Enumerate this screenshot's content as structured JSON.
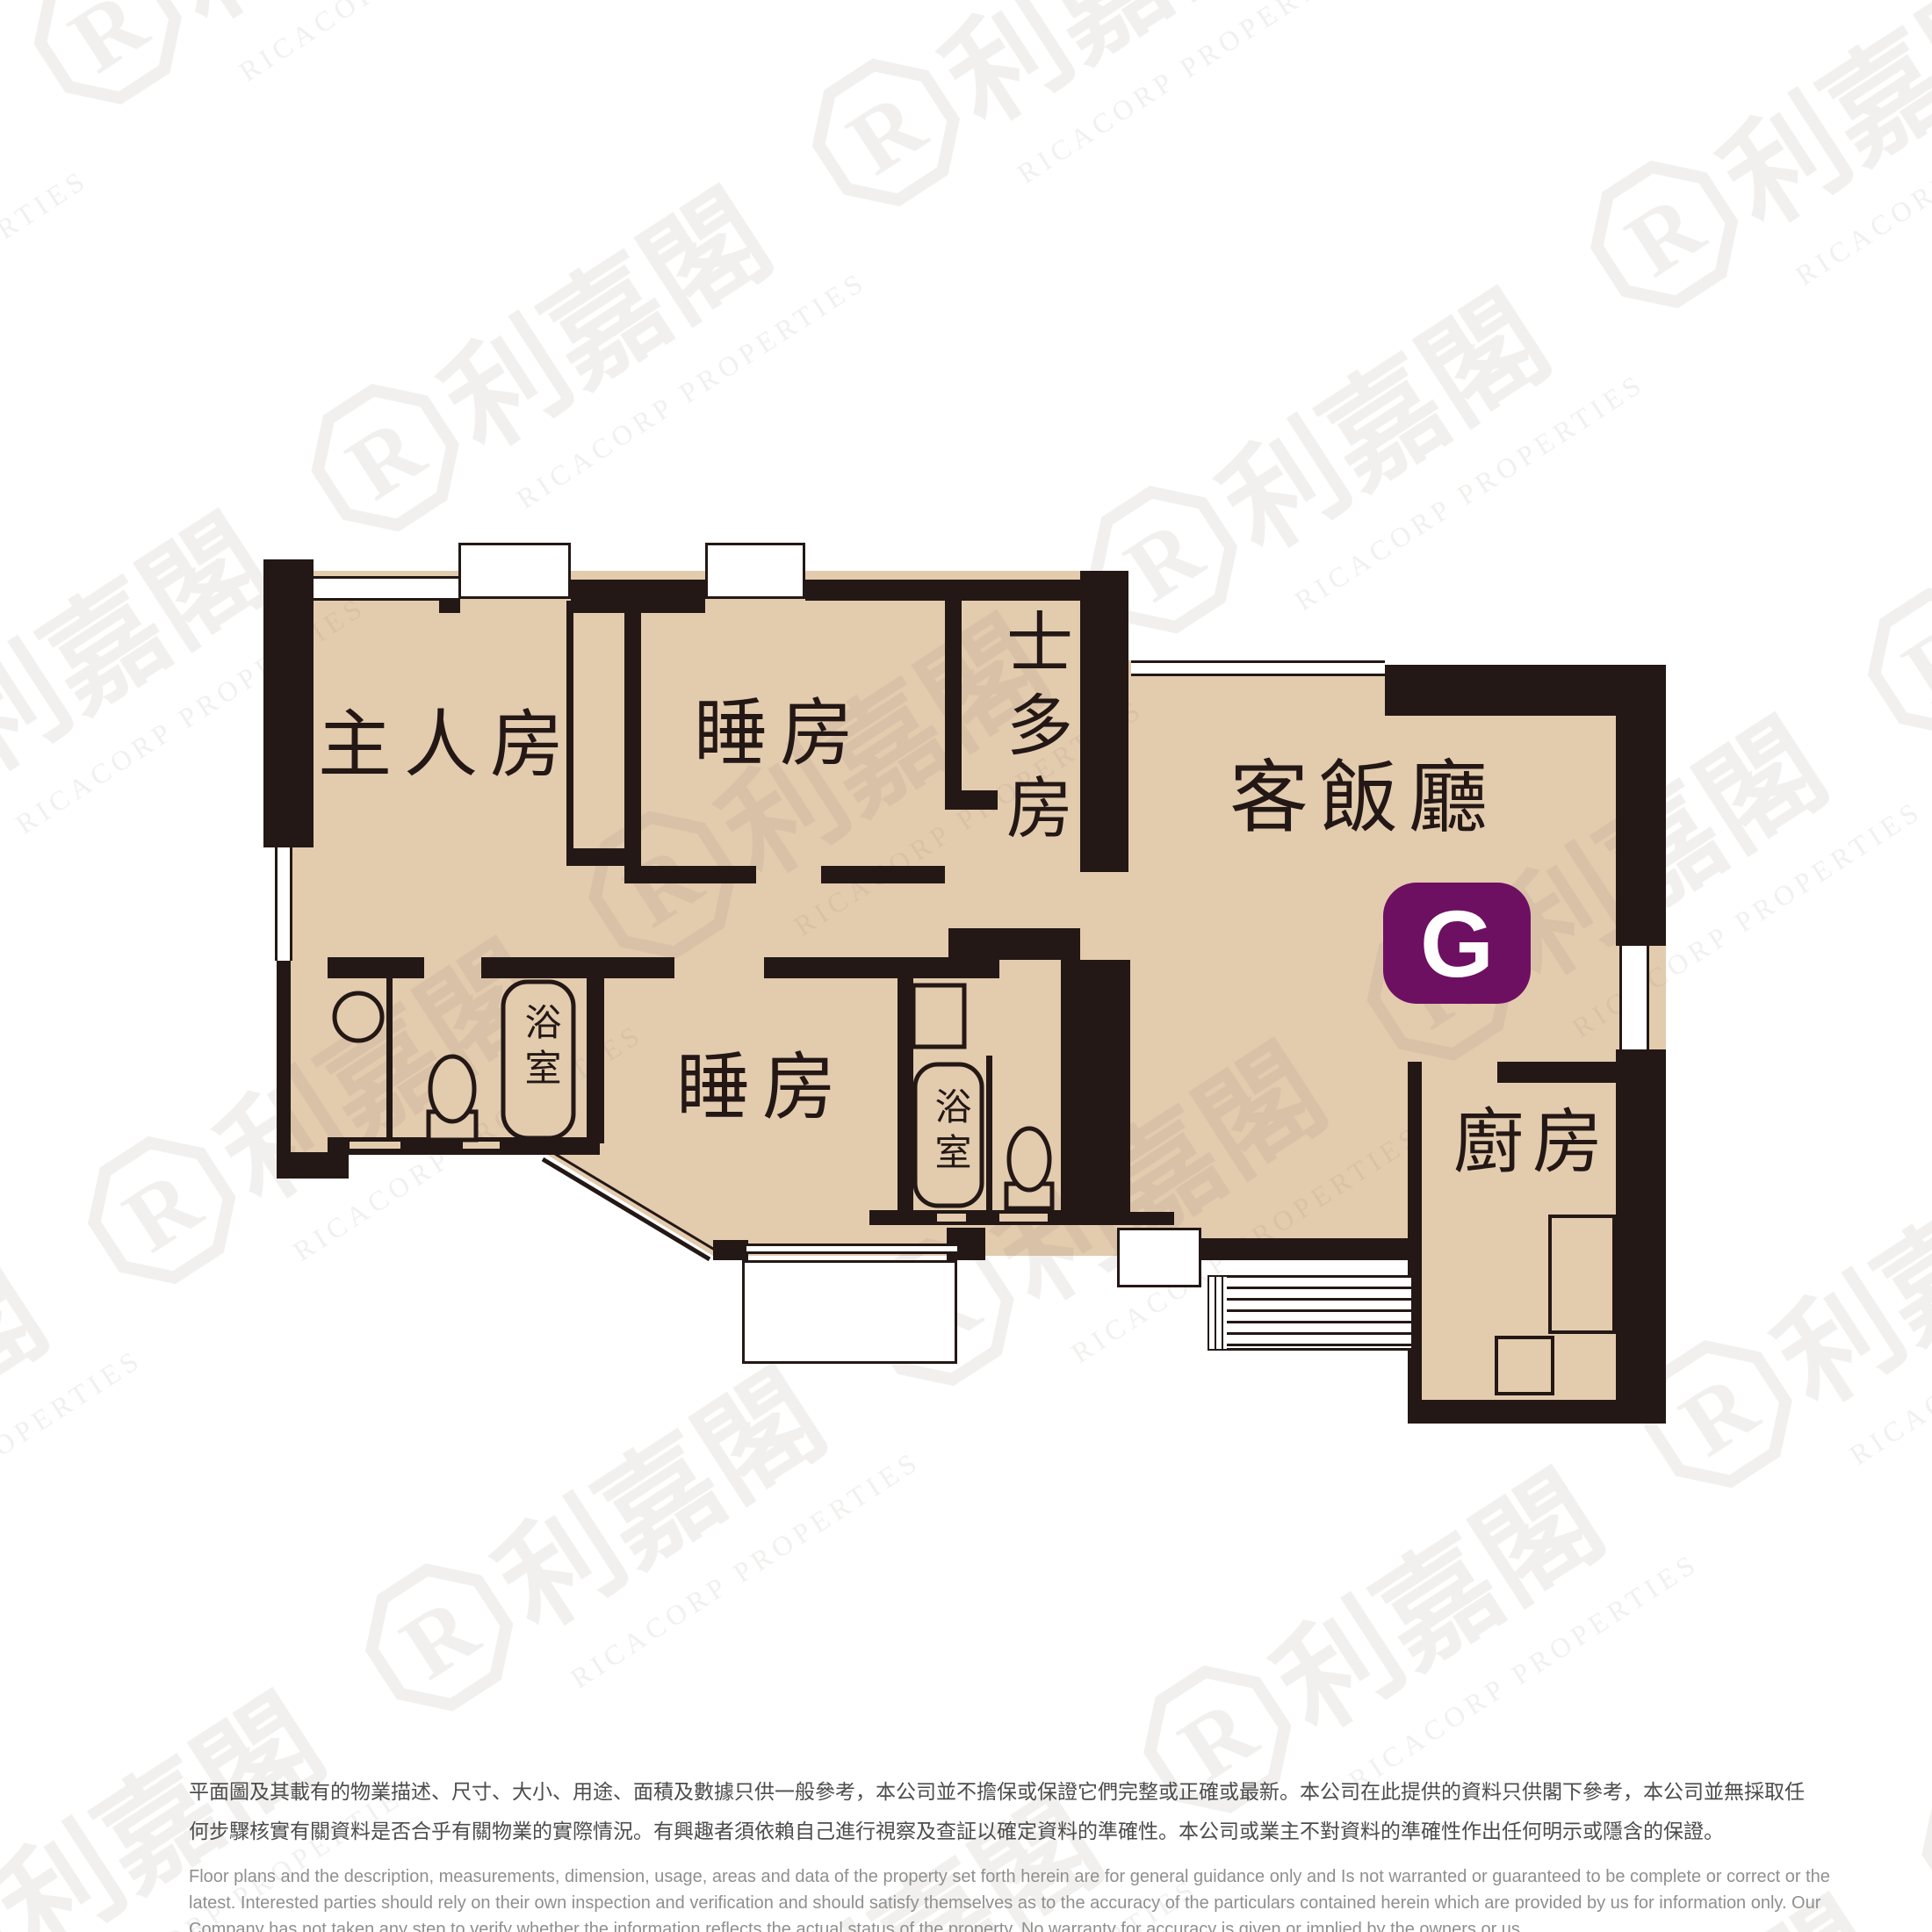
{
  "floor_plan": {
    "unit_badge": "G",
    "badge_color": "#6D1062",
    "floor_color": "#E3CBAE",
    "wall_color": "#231815",
    "rooms": {
      "master_bedroom": {
        "label": "主人房"
      },
      "bedroom_top": {
        "label": "睡房"
      },
      "storeroom": {
        "label": "士多房"
      },
      "living_dining": {
        "label": "客飯廳"
      },
      "bedroom_bottom": {
        "label": "睡房"
      },
      "bathroom_1": {
        "label": "浴室"
      },
      "bathroom_2": {
        "label": "浴室"
      },
      "kitchen": {
        "label": "廚房"
      }
    }
  },
  "watermark": {
    "logo_letter": "R",
    "logo_text": "利嘉閣",
    "company_text": "RICACORP PROPERTIES"
  },
  "disclaimer": {
    "chinese_line_1": "平面圖及其載有的物業描述、尺寸、大小、用途、面積及數據只供一般參考，本公司並不擔保或保證它們完整或正確或最新。本公司在此提供的資料只供閣下參考，本公司並無採取任",
    "chinese_line_2": "何步驟核實有關資料是否合乎有關物業的實際情況。有興趣者須依賴自己進行視察及查証以確定資料的準確性。本公司或業主不對資料的準確性作出任何明示或隱含的保證。",
    "english_line_1": "Floor plans and the description, measurements, dimension, usage, areas and data of the property set forth herein are for general guidance only and Is not warranted or guaranteed to be complete or correct or the",
    "english_line_2": "latest. Interested parties should rely on their own inspection and verification and should satisfy themselves as to the accuracy of the particulars contained herein which are provided by us for information only.  Our",
    "english_line_3": "Company has not taken any step to verify whether the information reflects the actual status of the property.  No warranty for accuracy is given or implied by the owners or us."
  }
}
